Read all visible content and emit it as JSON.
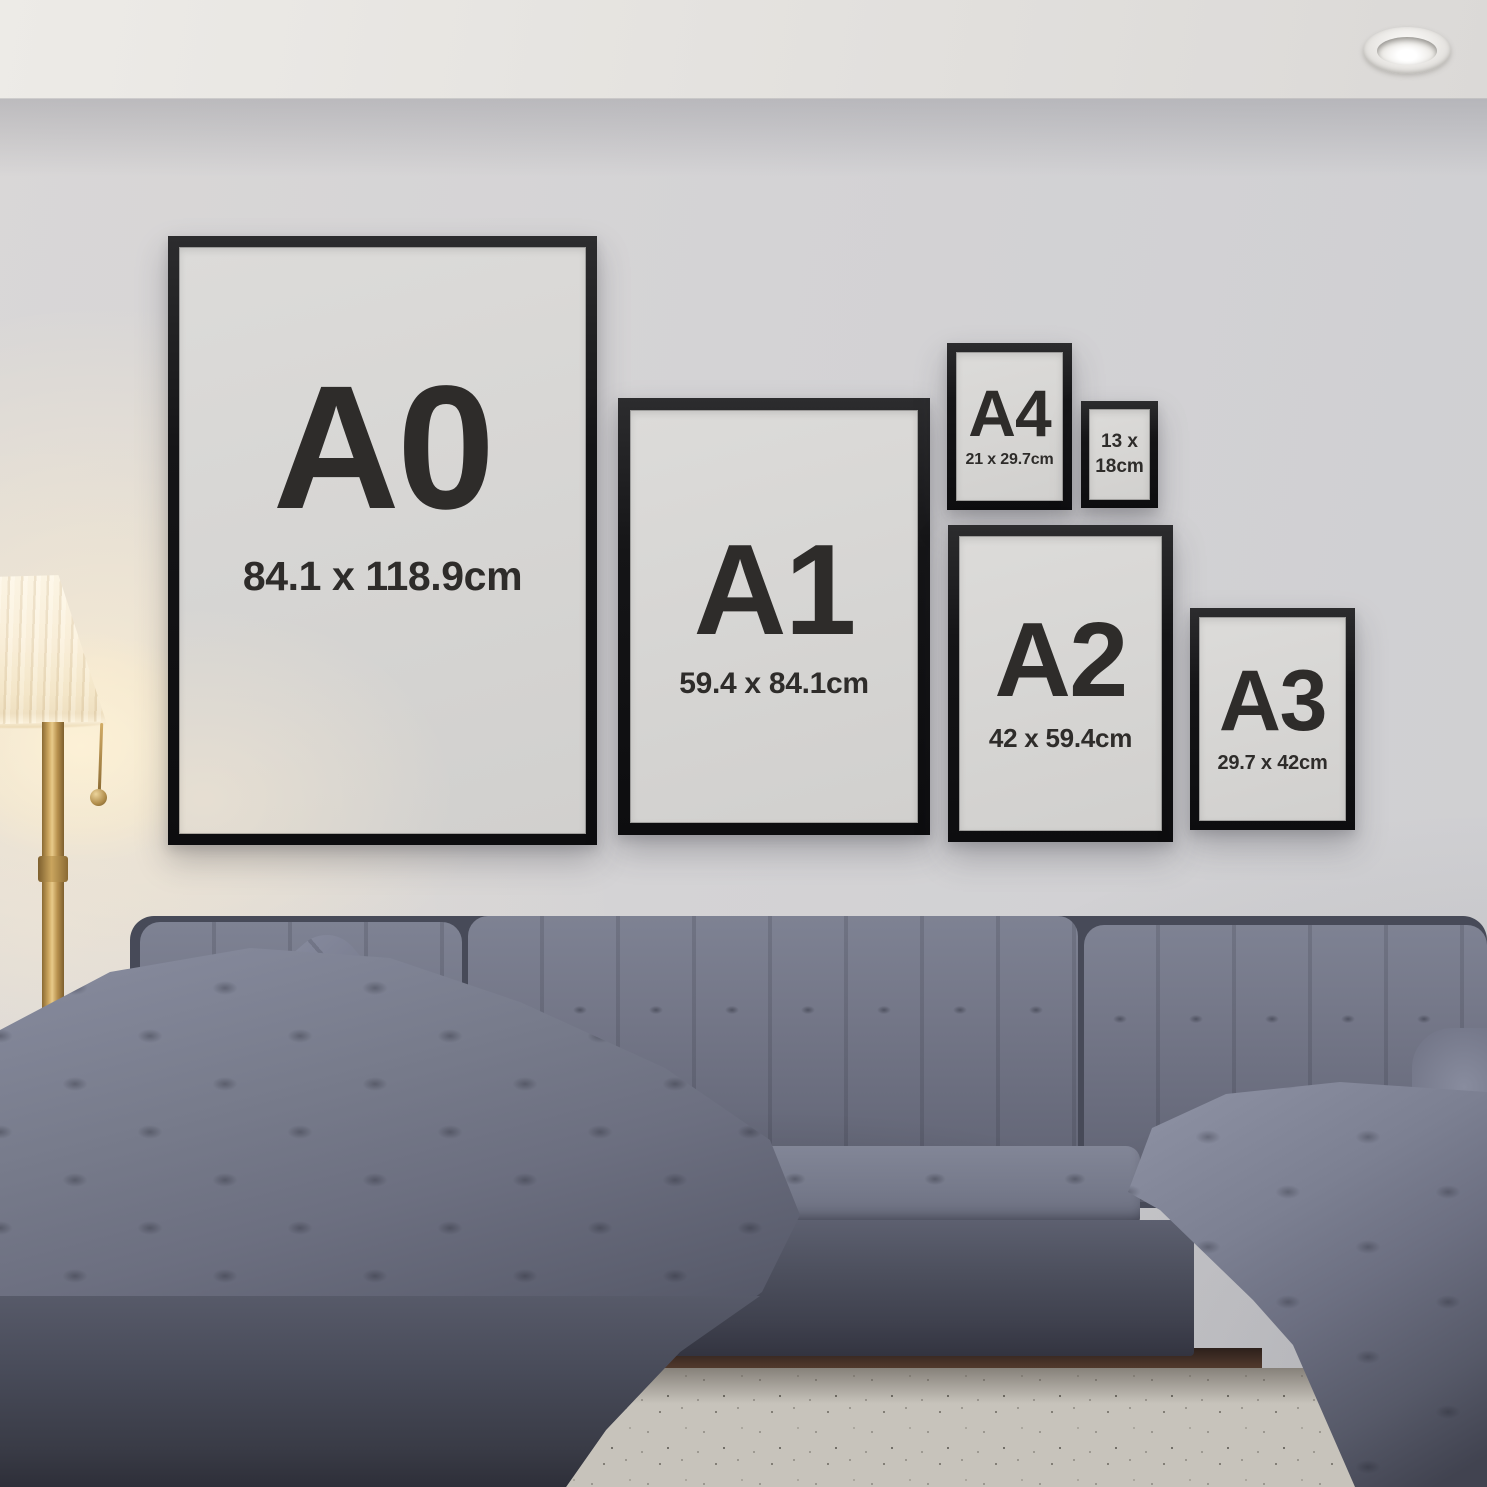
{
  "scene": {
    "description": "living room poster size comparison mockup",
    "wall_color": "#d4d3d5",
    "ceiling_color": "#e9e7e4",
    "frame_border_color": "#141416",
    "frame_mat_color": "#d7d6d4",
    "text_color": "#2e2c2a",
    "sofa_color": "#6f7284",
    "rug_color": "#c7c3bb",
    "floor_color": "#4c352a",
    "lamp_shade_color": "#faf0dc",
    "lamp_pole_color": "#b8914e"
  },
  "frames": [
    {
      "id": "a0",
      "label": "A0",
      "dims": "84.1 x 118.9cm"
    },
    {
      "id": "a1",
      "label": "A1",
      "dims": "59.4 x 84.1cm"
    },
    {
      "id": "a4",
      "label": "A4",
      "dims": "21 x 29.7cm"
    },
    {
      "id": "size-13x18",
      "dims_line1": "13 x",
      "dims_line2": "18cm"
    },
    {
      "id": "a2",
      "label": "A2",
      "dims": "42 x 59.4cm"
    },
    {
      "id": "a3",
      "label": "A3",
      "dims": "29.7 x 42cm"
    }
  ]
}
